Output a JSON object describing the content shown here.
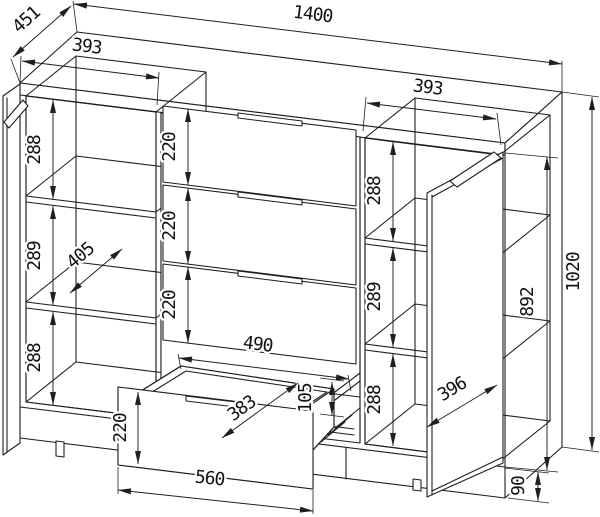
{
  "colors": {
    "line": "#1f1f1f",
    "background": "#ffffff"
  },
  "dims": {
    "overall_width": "1400",
    "overall_depth": "451",
    "overall_height": "1020",
    "left_section_width": "393",
    "right_section_width": "393",
    "interior_depth": "405",
    "left_spaces": {
      "top": "288",
      "middle": "289",
      "bottom": "288"
    },
    "right_spaces": {
      "top": "288",
      "middle": "289",
      "bottom": "288"
    },
    "drawer_fronts": {
      "first": "220",
      "second": "220",
      "third": "220"
    },
    "door": {
      "height": "892",
      "width": "396"
    },
    "plinth_height": "90",
    "open_drawer": {
      "inner_width": "490",
      "side_height": "105",
      "inner_depth": "383",
      "front_height": "220",
      "front_width": "560"
    }
  }
}
